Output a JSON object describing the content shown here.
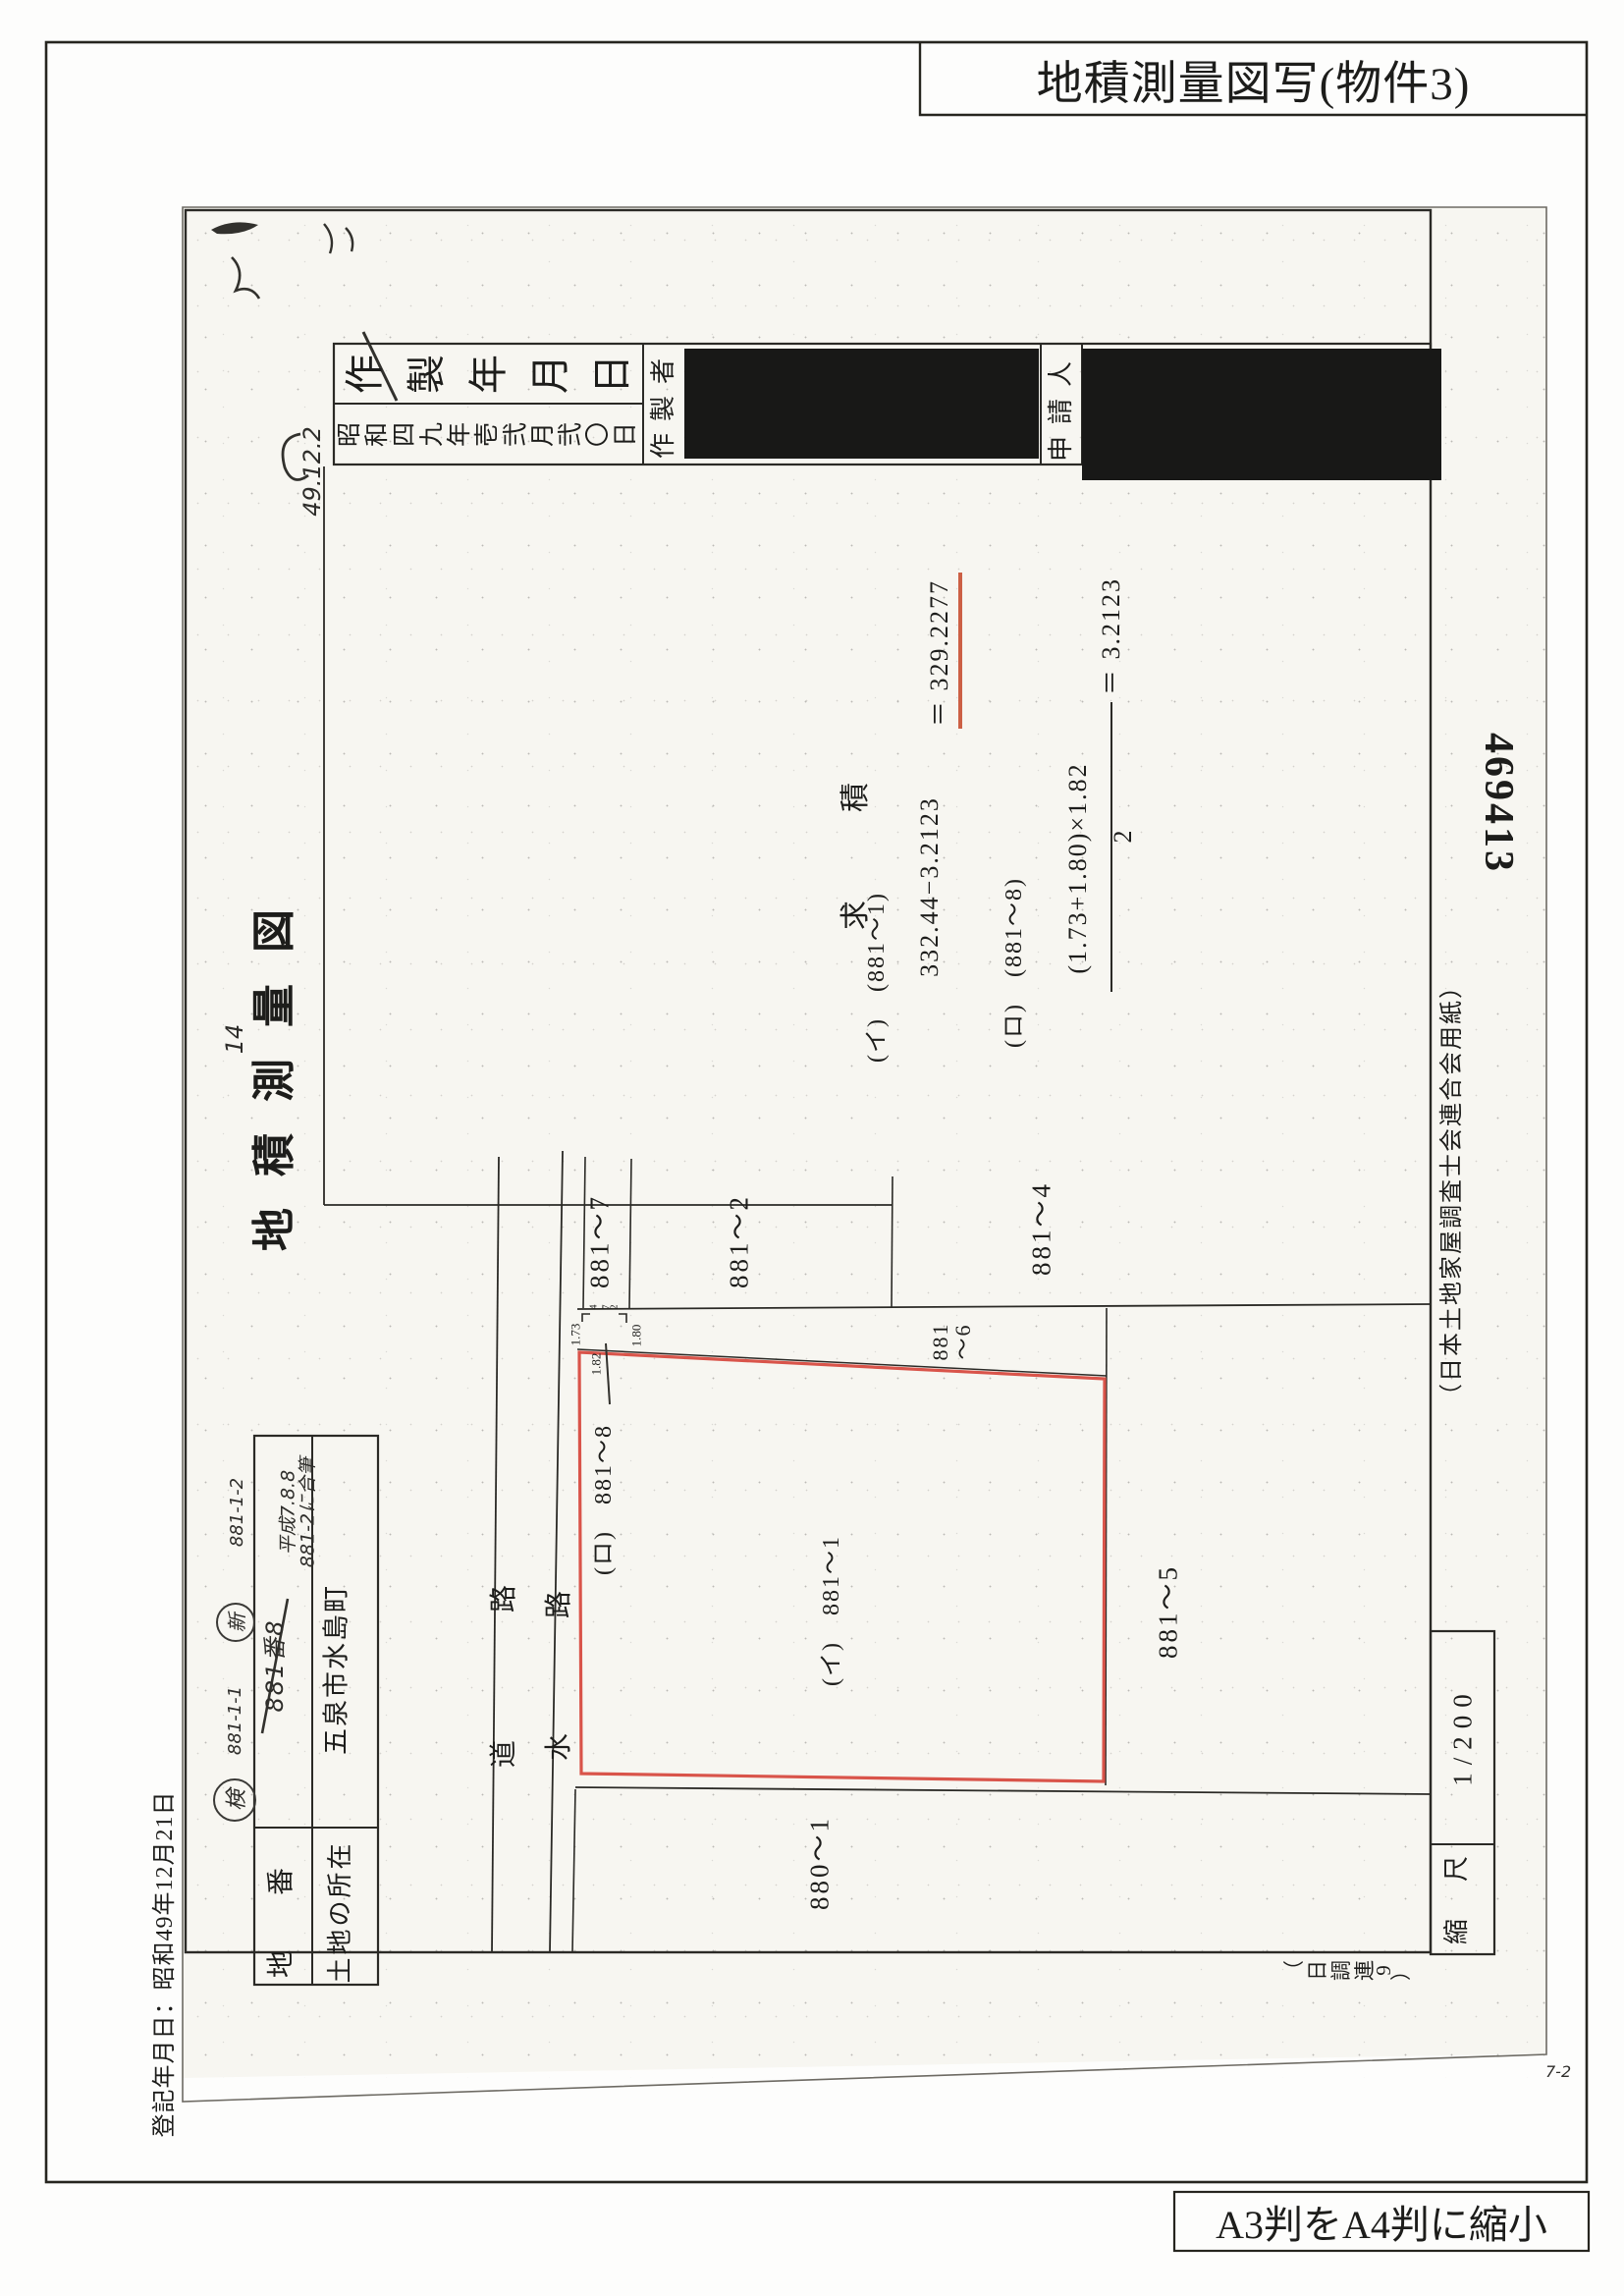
{
  "page": {
    "copy_title": "地積測量図写(物件3)",
    "reduction_note": "A3判をA4判に縮小",
    "registration_note": "登記年月日：昭和49年12月21日",
    "page_mark": "7-2"
  },
  "margin": {
    "serial_number": "469413",
    "paper_note": "（日本土地家屋調査士会連合会用紙）",
    "form_code": "（日調連9）"
  },
  "header": {
    "created_label": "作製年月日",
    "created_value": "昭和四九年壱弐月弐〇日",
    "creator_label": "作製者",
    "applicant_label": "申請人"
  },
  "doc": {
    "title": "地積測量図",
    "sheet_note": "14"
  },
  "handwriting": {
    "date_note": "49.12.2",
    "parcel_old": "881番8",
    "merge_date": "平成7.8.8",
    "merge_note": "881-2に合筆",
    "stamp_old": "検",
    "stamp_new": "新",
    "margin_note_1": "881-1-1",
    "margin_note_2": "881-1-2"
  },
  "land_table": {
    "lot_label": "地　番",
    "location_label": "土地の所在",
    "location_value": "五泉市水島町"
  },
  "calc": {
    "heading": "求　積",
    "row1_label": "(イ)　(881〜1)",
    "row1_expr": "332.44−3.2123",
    "row1_result": "＝ 329.2277",
    "row2_label": "(ロ)　(881〜8)",
    "row2_numerator": "(1.73+1.80)×1.82",
    "row2_denominator": "2",
    "row2_result": "＝ 3.2123"
  },
  "map": {
    "labels": {
      "lot_881_7": "881〜7",
      "lot_881_2": "881〜2",
      "lot_881_4": "881〜4",
      "lot_881_6a": "881",
      "lot_881_6b": "〜6",
      "lot_881_8": "(ロ)　881〜8",
      "lot_881_1": "(イ)　881〜1",
      "lot_881_5": "881〜5",
      "lot_880_1": "880〜1",
      "road": "道路",
      "water": "水路"
    },
    "dims": {
      "d1": "1.73",
      "d2": "1.80",
      "d3": "1.82",
      "d4": "4.72"
    },
    "scale_label": "縮　尺",
    "scale_value": "1/200"
  },
  "colors": {
    "parcel_red": "#d9544a",
    "underline_red": "#cc6045",
    "ink": "#2b2a26"
  }
}
